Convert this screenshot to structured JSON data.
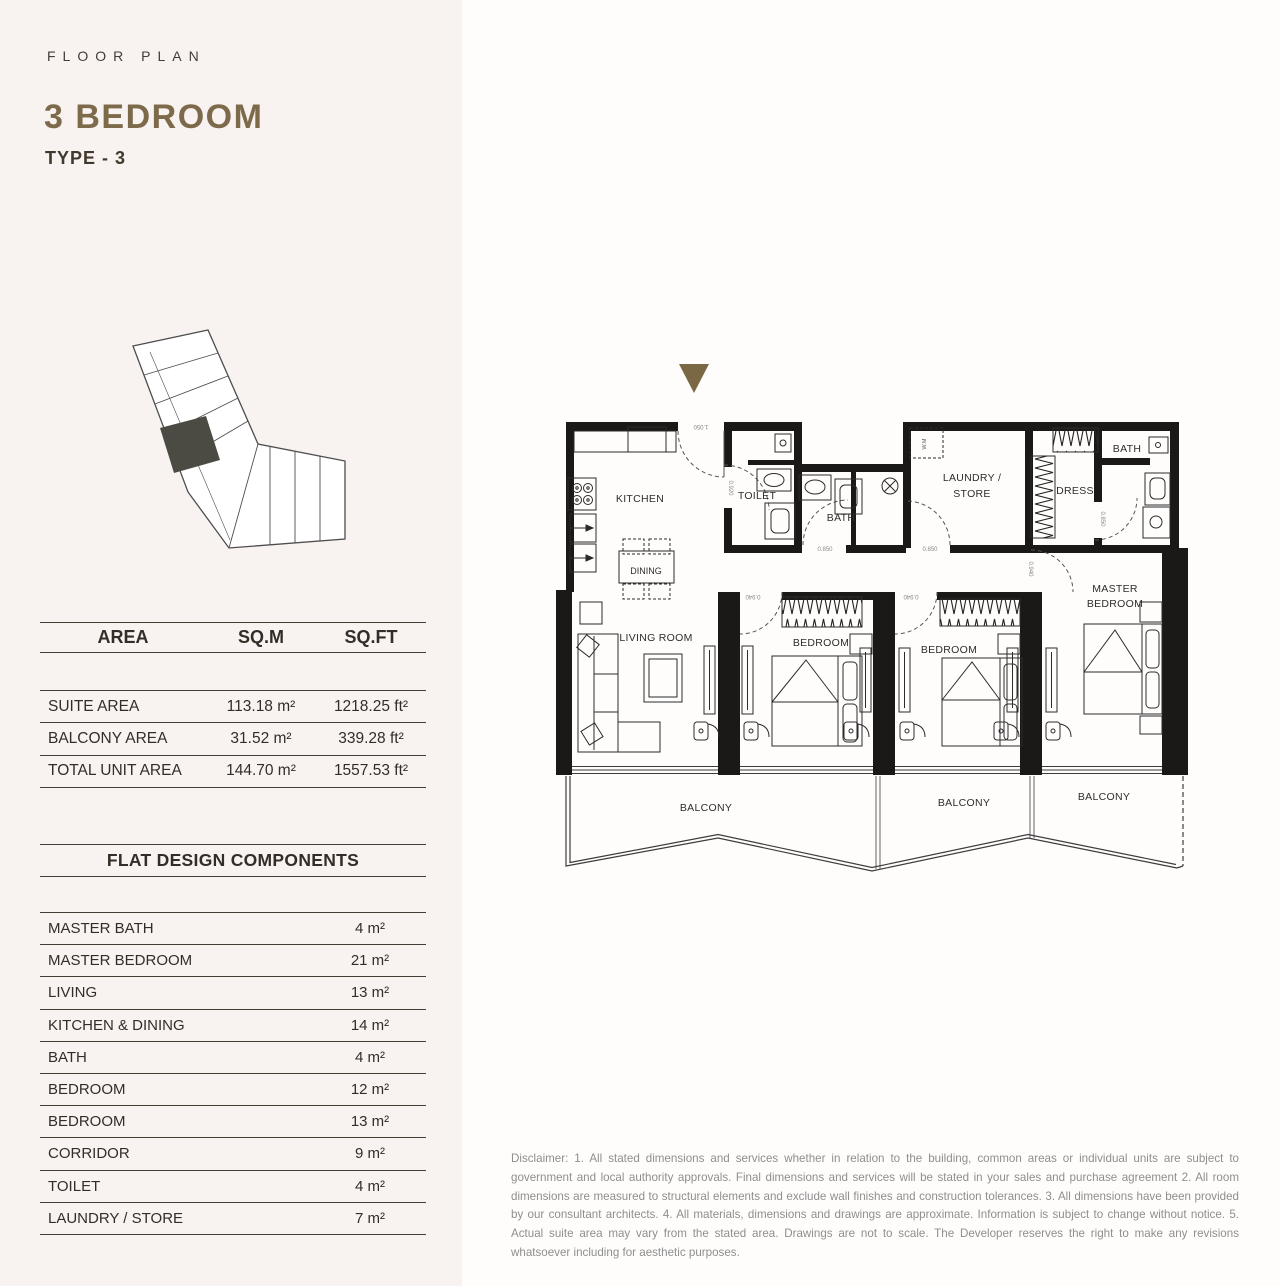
{
  "header": {
    "eyebrow": "FLOOR PLAN",
    "title": "3 BEDROOM",
    "subtitle": "TYPE - 3",
    "title_color": "#7c6a4b"
  },
  "area_table": {
    "columns": [
      "AREA",
      "SQ.M",
      "SQ.FT"
    ],
    "rows": [
      {
        "label": "SUITE AREA",
        "sqm": "113.18 m²",
        "sqft": "1218.25 ft²"
      },
      {
        "label": "BALCONY AREA",
        "sqm": "31.52 m²",
        "sqft": "339.28 ft²"
      },
      {
        "label": "TOTAL UNIT AREA",
        "sqm": "144.70 m²",
        "sqft": "1557.53 ft²"
      }
    ]
  },
  "components_table": {
    "title": "FLAT DESIGN COMPONENTS",
    "rows": [
      {
        "label": "MASTER BATH",
        "value": "4 m²"
      },
      {
        "label": "MASTER BEDROOM",
        "value": "21 m²"
      },
      {
        "label": "LIVING",
        "value": "13 m²"
      },
      {
        "label": "KITCHEN & DINING",
        "value": "14 m²"
      },
      {
        "label": "BATH",
        "value": "4 m²"
      },
      {
        "label": "BEDROOM",
        "value": "12 m²"
      },
      {
        "label": "BEDROOM",
        "value": "13 m²"
      },
      {
        "label": "CORRIDOR",
        "value": "9 m²"
      },
      {
        "label": "TOILET",
        "value": "4 m²"
      },
      {
        "label": "LAUNDRY / STORE",
        "value": "7 m²"
      }
    ]
  },
  "floor_plan": {
    "entry_marker_color": "#7a6845",
    "labels": {
      "kitchen": "KITCHEN",
      "dining": "DINING",
      "living_room": "LIVING ROOM",
      "toilet": "TOILET",
      "bath": "BATH",
      "master_bath": "BATH",
      "laundry_line1": "LAUNDRY /",
      "laundry_line2": "STORE",
      "dress": "DRESS",
      "master_line1": "MASTER",
      "master_line2": "BEDROOM",
      "bedroom_1": "BEDROOM",
      "bedroom_2": "BEDROOM",
      "balcony": "BALCONY",
      "washing_machine": "W.M"
    },
    "dimensions": {
      "entry": "1.050",
      "toilet_side": "0.920",
      "bath_door": "0.850",
      "laundry_door": "0.850",
      "bedroom1_door": "0.940",
      "bedroom2_door": "0.940",
      "master_door": "0.940",
      "master_bath_door": "0.850"
    }
  },
  "disclaimer": "Disclaimer: 1. All stated dimensions and services whether in relation to the building, common areas or individual units are subject to government and local authority approvals. Final dimensions and services will be stated in your sales and purchase agreement 2. All room dimensions are measured to structural elements and exclude wall finishes and construction tolerances. 3. All dimensions have been provided by our consultant architects. 4. All materials, dimensions and drawings are approximate. Information is subject to change without notice. 5. Actual suite area may vary from the stated area. Drawings are not to scale. The Developer reserves the right to make any revisions whatsoever including for aesthetic purposes."
}
